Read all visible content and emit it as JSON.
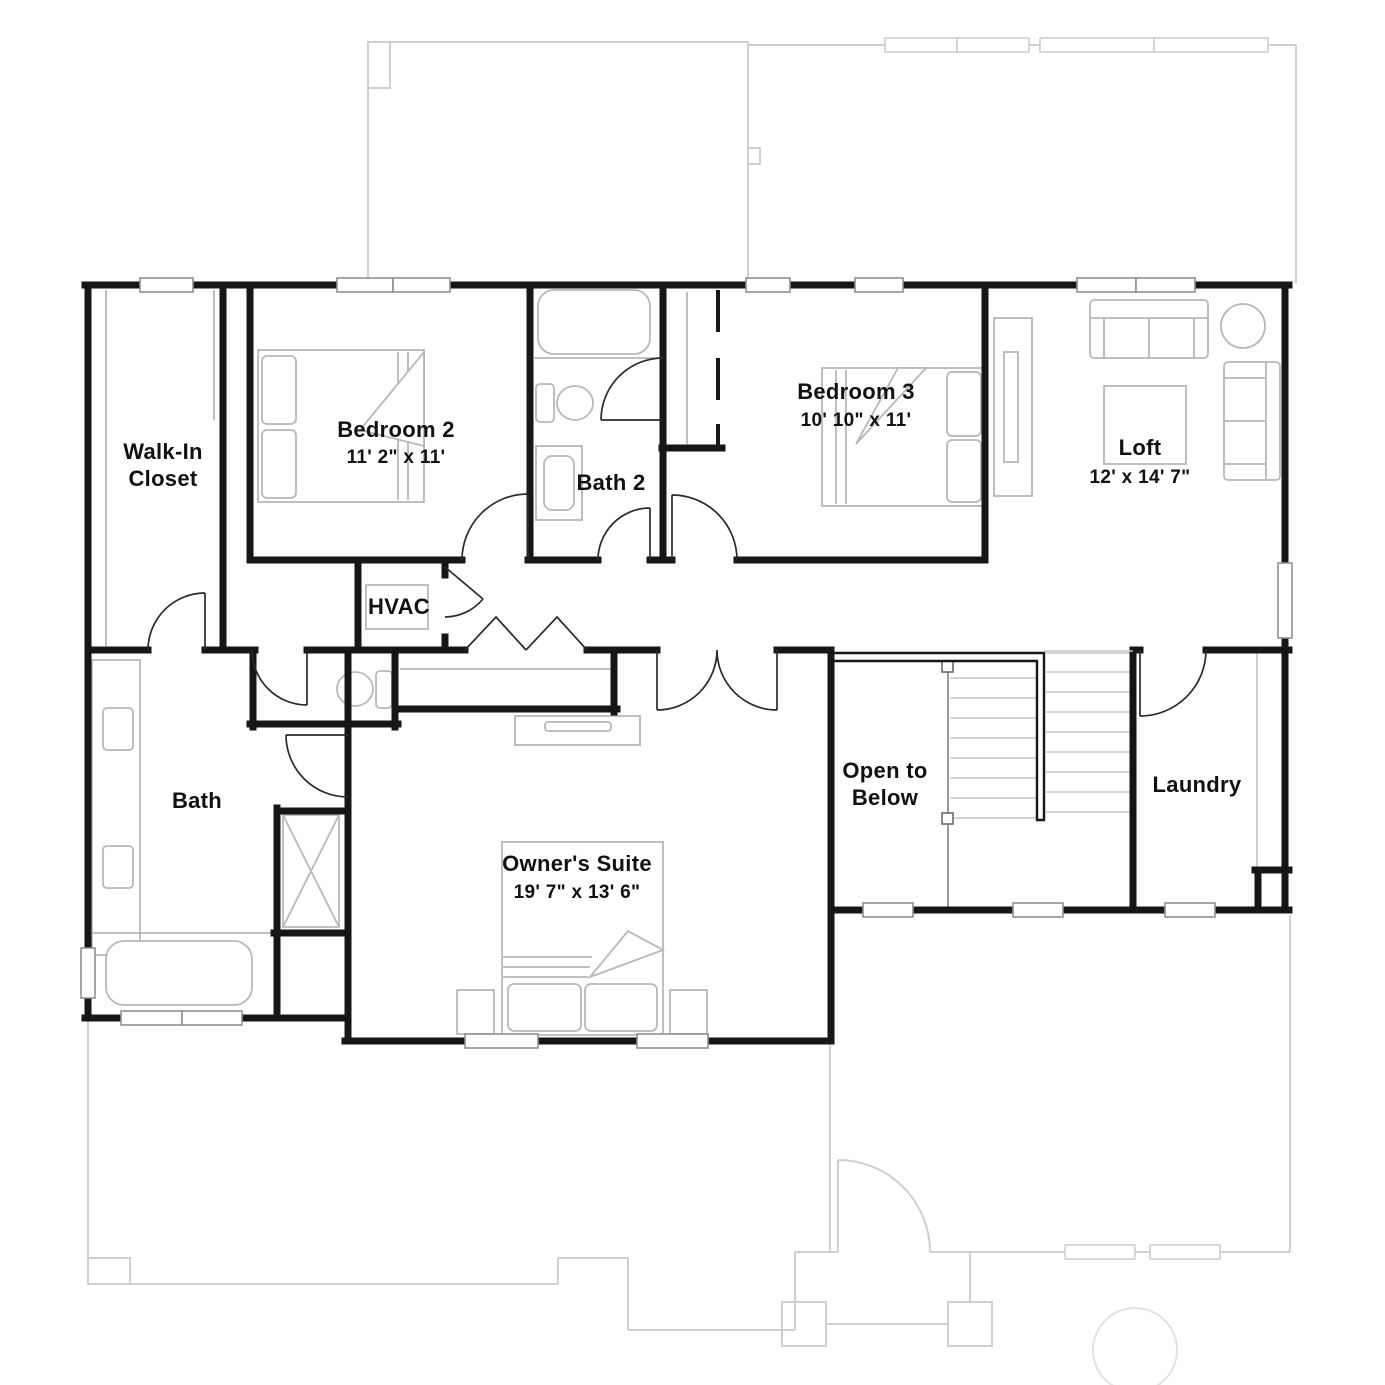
{
  "colors": {
    "wall": "#161616",
    "ghost": "#cfcfcf",
    "furniture": "#b8b8b8",
    "window_border": "#909090",
    "text": "#111111"
  },
  "rooms": {
    "walk_in_closet": {
      "name": "Walk-In Closet",
      "line1": "Walk-In",
      "line2": "Closet"
    },
    "bedroom_2": {
      "name": "Bedroom 2",
      "dims": "11' 2\" x 11'"
    },
    "bath_2": {
      "name": "Bath 2"
    },
    "bedroom_3": {
      "name": "Bedroom 3",
      "dims": "10' 10\" x 11'"
    },
    "loft": {
      "name": "Loft",
      "dims": "12' x 14' 7\""
    },
    "hvac": {
      "name": "HVAC"
    },
    "bath": {
      "name": "Bath"
    },
    "owners_suite": {
      "name": "Owner's Suite",
      "dims": "19' 7\" x 13' 6\""
    },
    "open_to_below": {
      "name": "Open to Below",
      "line1": "Open to",
      "line2": "Below"
    },
    "laundry": {
      "name": "Laundry"
    }
  }
}
